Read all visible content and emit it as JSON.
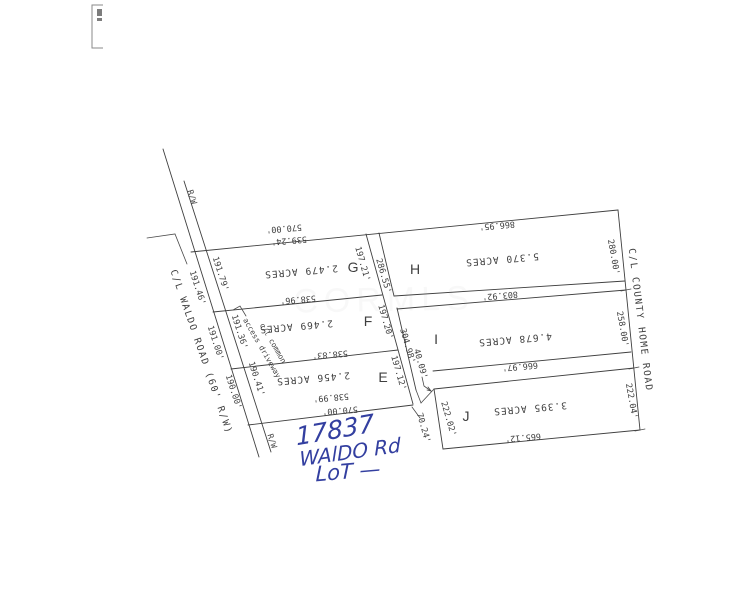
{
  "page": {
    "background": "#ffffff",
    "ink": "#3f3f3f",
    "handwriting_color": "#333fa0",
    "watermark_color": "#9a9a9a"
  },
  "parcels": [
    {
      "letter": "G",
      "acres": "2.479 ACRES"
    },
    {
      "letter": "F",
      "acres": "2.469 ACRES"
    },
    {
      "letter": "E",
      "acres": "2.456 ACRES"
    },
    {
      "letter": "H",
      "acres": "5.370 ACRES"
    },
    {
      "letter": "I",
      "acres": "4.678 ACRES"
    },
    {
      "letter": "J",
      "acres": "3.395 ACRES"
    }
  ],
  "roads": {
    "waldo": "C/L WALDO ROAD (60' R/W)",
    "county_home": "C/L COUNTY HOME ROAD"
  },
  "handwritten_note": [
    "17837",
    "WAlDO Rd",
    "LoT —"
  ],
  "labels": [
    {
      "name": "dim-north-570",
      "text": "570.00'",
      "x": 284,
      "y": 228,
      "rot": 175,
      "size": 8.5,
      "font": "mono"
    },
    {
      "name": "dim-north-539",
      "text": "539.24'",
      "x": 289,
      "y": 240,
      "rot": 175,
      "size": 8.5,
      "font": "mono"
    },
    {
      "name": "parcel-g-acres",
      "text": "2.479 ACRES",
      "x": 301,
      "y": 271,
      "rot": 175,
      "size": 9.5,
      "font": "mono",
      "ls": 1
    },
    {
      "name": "parcel-g-letter",
      "text": "G",
      "x": 353,
      "y": 267,
      "rot": 0,
      "size": 14,
      "font": "sans"
    },
    {
      "name": "dim-g-south",
      "text": "538.96'",
      "x": 298,
      "y": 299,
      "rot": 175,
      "size": 8.5,
      "font": "mono"
    },
    {
      "name": "parcel-f-acres",
      "text": "2.469 ACRES",
      "x": 296,
      "y": 326,
      "rot": 175,
      "size": 9.5,
      "font": "mono",
      "ls": 1
    },
    {
      "name": "parcel-f-letter",
      "text": "F",
      "x": 368,
      "y": 321,
      "rot": 0,
      "size": 14,
      "font": "sans"
    },
    {
      "name": "dim-f-south",
      "text": "538.83'",
      "x": 330,
      "y": 354,
      "rot": 175,
      "size": 8.5,
      "font": "mono"
    },
    {
      "name": "parcel-e-acres",
      "text": "2.456 ACRES",
      "x": 313,
      "y": 378,
      "rot": 175,
      "size": 9.5,
      "font": "mono",
      "ls": 1
    },
    {
      "name": "parcel-e-letter",
      "text": "E",
      "x": 383,
      "y": 377,
      "rot": 0,
      "size": 14,
      "font": "sans"
    },
    {
      "name": "dim-e-south-538",
      "text": "538.99'",
      "x": 331,
      "y": 397,
      "rot": 175,
      "size": 8.5,
      "font": "mono"
    },
    {
      "name": "dim-e-south-570",
      "text": "570.00'",
      "x": 340,
      "y": 410,
      "rot": 175,
      "size": 8.5,
      "font": "mono"
    },
    {
      "name": "parcel-h-acres",
      "text": "5.370 ACRES",
      "x": 502,
      "y": 259,
      "rot": 175,
      "size": 9.5,
      "font": "mono",
      "ls": 1
    },
    {
      "name": "parcel-h-letter",
      "text": "H",
      "x": 415,
      "y": 269,
      "rot": 0,
      "size": 14,
      "font": "sans"
    },
    {
      "name": "dim-h-north",
      "text": "866.95'",
      "x": 497,
      "y": 225,
      "rot": 175,
      "size": 8.5,
      "font": "mono"
    },
    {
      "name": "dim-h-south",
      "text": "803.92'",
      "x": 500,
      "y": 295,
      "rot": 175,
      "size": 8.5,
      "font": "mono"
    },
    {
      "name": "parcel-i-acres",
      "text": "4.678 ACRES",
      "x": 515,
      "y": 339,
      "rot": 175,
      "size": 9.5,
      "font": "mono",
      "ls": 1
    },
    {
      "name": "parcel-i-letter",
      "text": "I",
      "x": 436,
      "y": 339,
      "rot": 0,
      "size": 14,
      "font": "sans"
    },
    {
      "name": "dim-i-south",
      "text": "666.97'",
      "x": 520,
      "y": 366,
      "rot": 175,
      "size": 8.5,
      "font": "mono"
    },
    {
      "name": "parcel-j-acres",
      "text": "3.395 ACRES",
      "x": 530,
      "y": 408,
      "rot": 175,
      "size": 9.5,
      "font": "mono",
      "ls": 1
    },
    {
      "name": "parcel-j-letter",
      "text": "J",
      "x": 466,
      "y": 416,
      "rot": 0,
      "size": 14,
      "font": "sans"
    },
    {
      "name": "dim-j-south",
      "text": "665.12'",
      "x": 523,
      "y": 437,
      "rot": 175,
      "size": 8.5,
      "font": "mono"
    },
    {
      "name": "dim-g-frontage",
      "text": "191.79'",
      "x": 220,
      "y": 274,
      "rot": 72,
      "size": 8.5,
      "font": "mono"
    },
    {
      "name": "dim-f-frontage",
      "text": "191.36'",
      "x": 239,
      "y": 332,
      "rot": 72,
      "size": 8.5,
      "font": "mono"
    },
    {
      "name": "dim-e-frontage",
      "text": "190.41'",
      "x": 256,
      "y": 379,
      "rot": 72,
      "size": 8.5,
      "font": "mono"
    },
    {
      "name": "dim-waldo-cl-191-46",
      "text": "191.46'",
      "x": 197,
      "y": 288,
      "rot": 72,
      "size": 8.5,
      "font": "mono"
    },
    {
      "name": "dim-waldo-cl-191-00",
      "text": "191.00'",
      "x": 215,
      "y": 343,
      "rot": 72,
      "size": 8.5,
      "font": "mono"
    },
    {
      "name": "dim-waldo-cl-190-00",
      "text": "190.00'",
      "x": 233,
      "y": 392,
      "rot": 72,
      "size": 8.5,
      "font": "mono"
    },
    {
      "name": "label-rw-top",
      "text": "R/W",
      "x": 192,
      "y": 197,
      "rot": 72,
      "size": 8,
      "font": "mono"
    },
    {
      "name": "label-rw-bottom",
      "text": "R/W",
      "x": 272,
      "y": 441,
      "rot": 72,
      "size": 8,
      "font": "mono"
    },
    {
      "name": "waldo-road-name",
      "text": "C/L WALDO ROAD (60' R/W)",
      "x": 201,
      "y": 352,
      "rot": 71,
      "size": 9.5,
      "font": "mono",
      "ls": 1.5
    },
    {
      "name": "dim-g-east",
      "text": "197.21'",
      "x": 362,
      "y": 264,
      "rot": 74,
      "size": 8.5,
      "font": "mono"
    },
    {
      "name": "dim-h-west",
      "text": "286.55'",
      "x": 383,
      "y": 276,
      "rot": 74,
      "size": 8.5,
      "font": "mono"
    },
    {
      "name": "dim-f-east",
      "text": "197.20'",
      "x": 385,
      "y": 322,
      "rot": 74,
      "size": 8.5,
      "font": "mono"
    },
    {
      "name": "dim-i-west",
      "text": "304.98'",
      "x": 407,
      "y": 346,
      "rot": 74,
      "size": 8.5,
      "font": "mono"
    },
    {
      "name": "dim-e-east",
      "text": "197.12'",
      "x": 398,
      "y": 373,
      "rot": 74,
      "size": 8.5,
      "font": "mono"
    },
    {
      "name": "dim-notch-40",
      "text": "40.09'",
      "x": 420,
      "y": 364,
      "rot": 74,
      "size": 8.5,
      "font": "mono"
    },
    {
      "name": "dim-notch-70",
      "text": "70.24'",
      "x": 423,
      "y": 428,
      "rot": 74,
      "size": 8.5,
      "font": "mono"
    },
    {
      "name": "dim-j-west",
      "text": "222.02'",
      "x": 448,
      "y": 419,
      "rot": 74,
      "size": 8.5,
      "font": "mono"
    },
    {
      "name": "dim-h-east",
      "text": "280.00'",
      "x": 613,
      "y": 257,
      "rot": 80,
      "size": 8.5,
      "font": "mono"
    },
    {
      "name": "dim-i-east",
      "text": "258.00'",
      "x": 622,
      "y": 329,
      "rot": 80,
      "size": 8.5,
      "font": "mono"
    },
    {
      "name": "dim-j-east",
      "text": "222.04'",
      "x": 631,
      "y": 401,
      "rot": 80,
      "size": 8.5,
      "font": "mono"
    },
    {
      "name": "county-home-road-name",
      "text": "C/L COUNTY HOME ROAD",
      "x": 640,
      "y": 320,
      "rot": 83,
      "size": 9.5,
      "font": "mono",
      "ls": 1.5
    },
    {
      "name": "access-driveway-label-1",
      "text": "c/l common",
      "x": 273,
      "y": 343,
      "rot": 60,
      "size": 7.5,
      "font": "mono"
    },
    {
      "name": "access-driveway-label-2",
      "text": "access driveway",
      "x": 262,
      "y": 348,
      "rot": 60,
      "size": 7.5,
      "font": "mono"
    },
    {
      "name": "handwritten-address-number",
      "text": "17837",
      "x": 335,
      "y": 430,
      "rot": -10,
      "size": 25,
      "font": "hand"
    },
    {
      "name": "handwritten-street",
      "text": "WAlDO Rd",
      "x": 350,
      "y": 452,
      "rot": -8,
      "size": 20,
      "font": "hand"
    },
    {
      "name": "handwritten-lot",
      "text": "LoT —",
      "x": 348,
      "y": 471,
      "rot": -5,
      "size": 21,
      "font": "hand"
    },
    {
      "name": "watermark",
      "text": "CORMLS",
      "x": 384,
      "y": 300,
      "rot": -1,
      "size": 34,
      "font": "sans",
      "ls": 6,
      "opacity": 0.06,
      "watermark": true
    }
  ]
}
